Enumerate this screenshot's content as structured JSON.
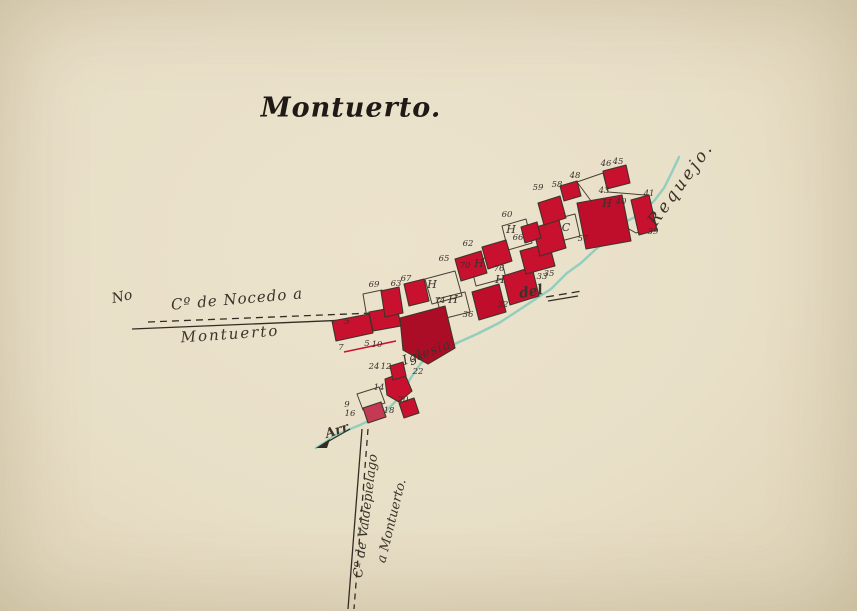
{
  "palette": {
    "paper": "#eae1ca",
    "ink": "#332c24",
    "outline": "#4a3f33",
    "building": "#c8102f",
    "building_dark": "#ac0d26",
    "building_mid": "#bf0e2c",
    "stream": "#8cccbd"
  },
  "title": {
    "text": "Montuerto."
  },
  "labels": {
    "no": "No",
    "nocedo_top": "Cº de Nocedo a",
    "nocedo_bottom": "Montuerto",
    "valde_1": "Cº de Valdepielago",
    "valde_2": "a Montuerto.",
    "del": "del",
    "requejo": "Requejo.",
    "arr": "Arr",
    "iglesia": "Iglesia"
  },
  "roads": [
    {
      "name": "camino-nocedo-dashed",
      "d": "M 148,322 L 398,312",
      "dash": "7 5"
    },
    {
      "name": "camino-nocedo-solid",
      "d": "M 132,329 L 396,318",
      "dash": ""
    },
    {
      "name": "camino-east-dashed",
      "d": "M 546,297 L 582,291",
      "dash": "8 5"
    },
    {
      "name": "camino-east-solid",
      "d": "M 548,301 L 578,296",
      "dash": ""
    },
    {
      "name": "camino-valdepielago-solid",
      "d": "M 362,429 L 348,609",
      "dash": ""
    },
    {
      "name": "camino-valdepielago-dashed",
      "d": "M 368,429 L 354,609",
      "dash": "6 5"
    }
  ],
  "stream": {
    "points": "316,448 338,434 360,425 383,414 396,401 404,389 412,376 421,363 437,353 457,343 477,334 499,323 519,310 537,298 551,289 567,273 581,263 596,249 611,238 627,221 641,214 654,201 664,188 672,172 679,157"
  },
  "arrow": {
    "line": "M 350,429 L 322,445",
    "head": "316,448 330,439 327,448"
  },
  "red_line": {
    "d": "M 344,352 L 396,341"
  },
  "gardens": [
    {
      "pts": "577,182 603,173 608,192 645,195 653,227 636,233 600,213"
    },
    {
      "pts": "425,279 455,271 462,296 432,304"
    },
    {
      "pts": "437,299 465,292 470,312 442,319"
    },
    {
      "pts": "470,262 500,254 506,278 476,286"
    },
    {
      "pts": "502,226 526,219 532,243 508,250"
    },
    {
      "pts": "556,219 575,214 580,236 561,241"
    },
    {
      "pts": "363,294 382,290 386,314 367,318"
    },
    {
      "pts": "357,394 379,387 385,403 363,410"
    }
  ],
  "buildings": [
    {
      "pts": "332,321 369,314 373,333 336,341"
    },
    {
      "pts": "369,312 397,307 401,326 373,331"
    },
    {
      "pts": "381,291 399,287 403,313 385,317"
    },
    {
      "pts": "404,284 424,279 429,301 409,306"
    },
    {
      "pts": "400,318 445,306 455,348 428,364 403,350",
      "f": "#ac0d26"
    },
    {
      "pts": "455,259 481,251 487,273 461,281"
    },
    {
      "pts": "482,247 506,240 512,261 488,269"
    },
    {
      "pts": "472,292 499,284 506,312 479,320",
      "f": "#bf0e2c"
    },
    {
      "pts": "503,276 532,267 539,296 510,305"
    },
    {
      "pts": "520,251 549,243 555,266 526,274"
    },
    {
      "pts": "533,228 559,220 566,248 540,256"
    },
    {
      "pts": "538,203 560,196 566,218 544,225"
    },
    {
      "pts": "577,203 622,195 631,241 586,249",
      "f": "#bf0e2c"
    },
    {
      "pts": "603,171 626,165 630,183 607,189"
    },
    {
      "pts": "631,200 649,195 657,230 639,235"
    },
    {
      "pts": "521,227 537,222 541,238 525,243"
    },
    {
      "pts": "560,186 577,181 581,196 564,201"
    },
    {
      "pts": "385,379 404,372 412,391 399,402 387,395"
    },
    {
      "pts": "399,403 414,398 419,413 404,418"
    },
    {
      "pts": "363,408 381,402 386,417 368,423",
      "f": "#c43a55"
    },
    {
      "pts": "390,366 403,362 406,376 393,380"
    }
  ],
  "numbers": [
    {
      "t": "45",
      "x": 618,
      "y": 164
    },
    {
      "t": "46",
      "x": 606,
      "y": 166
    },
    {
      "t": "48",
      "x": 575,
      "y": 178
    },
    {
      "t": "43",
      "x": 604,
      "y": 193
    },
    {
      "t": "41",
      "x": 649,
      "y": 196
    },
    {
      "t": "40",
      "x": 621,
      "y": 204
    },
    {
      "t": "39",
      "x": 653,
      "y": 234
    },
    {
      "t": "58",
      "x": 557,
      "y": 187
    },
    {
      "t": "59",
      "x": 538,
      "y": 190
    },
    {
      "t": "57",
      "x": 583,
      "y": 241
    },
    {
      "t": "60",
      "x": 507,
      "y": 217
    },
    {
      "t": "62",
      "x": 468,
      "y": 246
    },
    {
      "t": "65",
      "x": 444,
      "y": 261
    },
    {
      "t": "66",
      "x": 518,
      "y": 240
    },
    {
      "t": "67",
      "x": 406,
      "y": 281
    },
    {
      "t": "69",
      "x": 374,
      "y": 287
    },
    {
      "t": "70",
      "x": 465,
      "y": 268
    },
    {
      "t": "76",
      "x": 499,
      "y": 271
    },
    {
      "t": "63",
      "x": 396,
      "y": 286
    },
    {
      "t": "74",
      "x": 440,
      "y": 303
    },
    {
      "t": "36",
      "x": 468,
      "y": 317
    },
    {
      "t": "35",
      "x": 549,
      "y": 276
    },
    {
      "t": "33",
      "x": 542,
      "y": 279
    },
    {
      "t": "32",
      "x": 503,
      "y": 307
    },
    {
      "t": "26",
      "x": 417,
      "y": 360
    },
    {
      "t": "24",
      "x": 374,
      "y": 369
    },
    {
      "t": "12",
      "x": 386,
      "y": 369
    },
    {
      "t": "22",
      "x": 418,
      "y": 374
    },
    {
      "t": "14",
      "x": 379,
      "y": 390
    },
    {
      "t": "20",
      "x": 403,
      "y": 402
    },
    {
      "t": "18",
      "x": 389,
      "y": 413
    },
    {
      "t": "16",
      "x": 350,
      "y": 416
    },
    {
      "t": "9",
      "x": 347,
      "y": 407
    },
    {
      "t": "7",
      "x": 341,
      "y": 350
    },
    {
      "t": "5",
      "x": 347,
      "y": 324
    },
    {
      "t": "5",
      "x": 367,
      "y": 346
    },
    {
      "t": "10",
      "x": 377,
      "y": 347
    }
  ],
  "letters": [
    {
      "t": "H",
      "x": 432,
      "y": 288
    },
    {
      "t": "H",
      "x": 453,
      "y": 303
    },
    {
      "t": "H",
      "x": 479,
      "y": 267
    },
    {
      "t": "H",
      "x": 500,
      "y": 283
    },
    {
      "t": "H",
      "x": 511,
      "y": 233
    },
    {
      "t": "H",
      "x": 607,
      "y": 207
    },
    {
      "t": "C",
      "x": 566,
      "y": 231
    }
  ]
}
